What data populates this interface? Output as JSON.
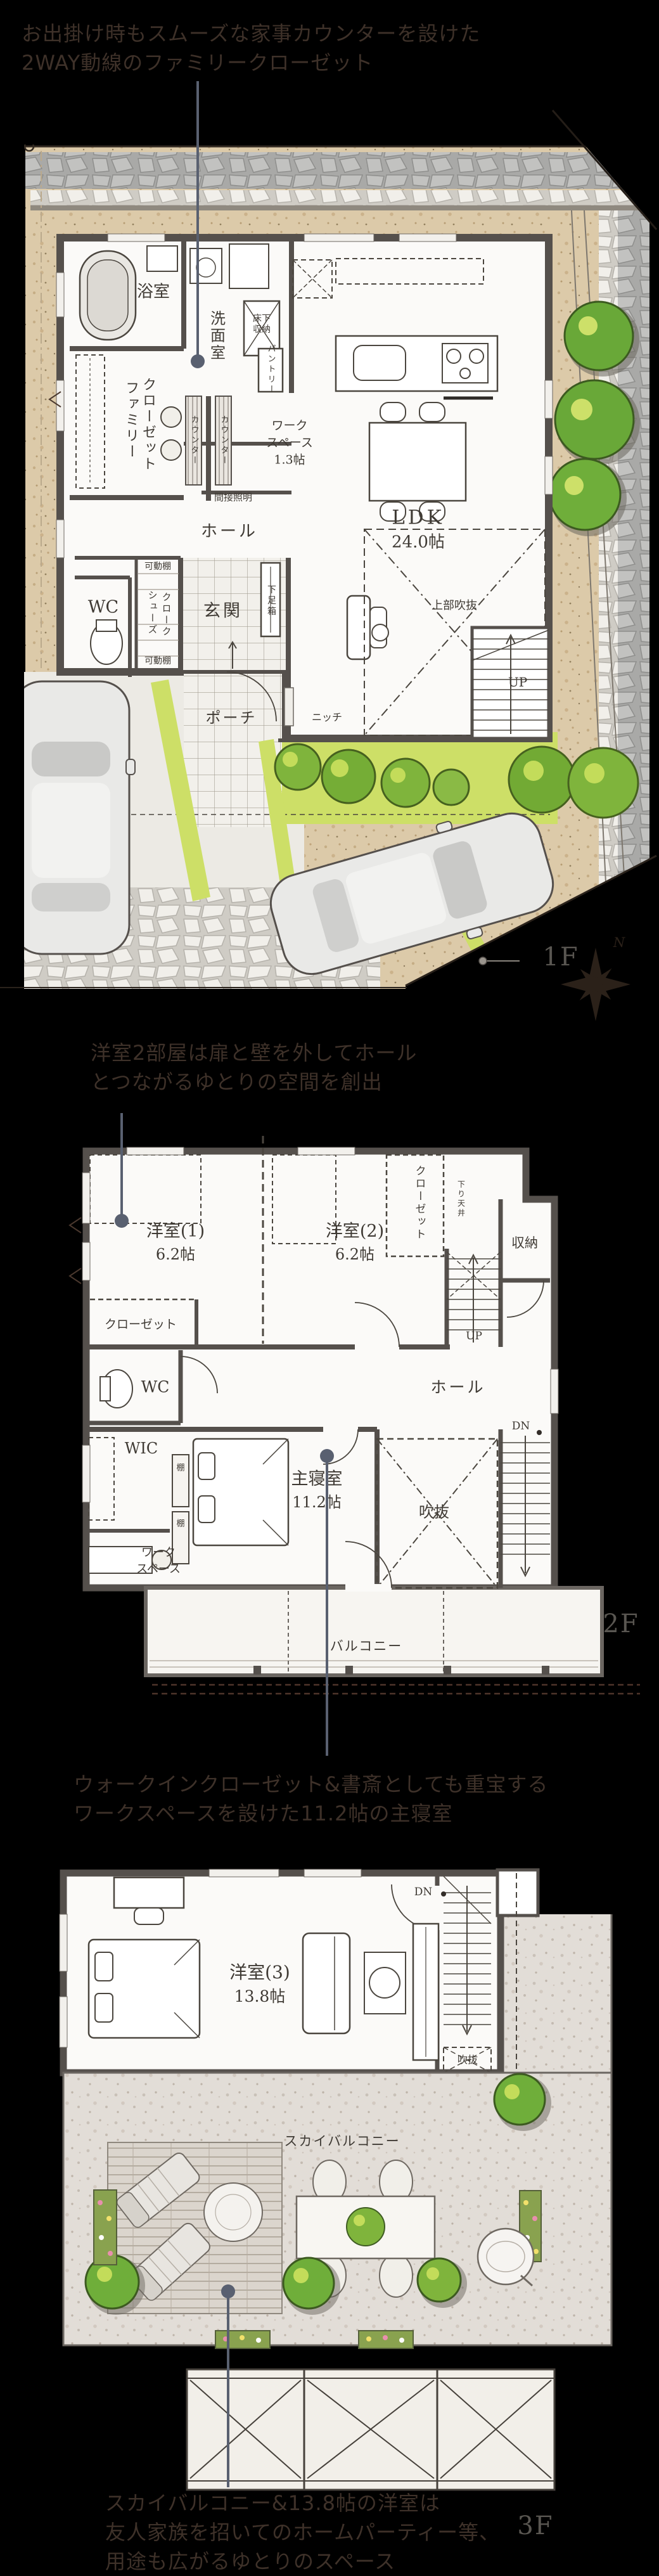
{
  "annotations": {
    "a1": {
      "lines": [
        "お出掛け時もスムーズな家事カウンターを設けた",
        "2WAY動線のファミリークローゼット"
      ]
    },
    "a2": {
      "lines": [
        "洋室2部屋は扉と壁を外してホール",
        "とつながるゆとりの空間を創出"
      ]
    },
    "a3": {
      "lines": [
        "ウォークインクローゼット&書斎としても重宝する",
        "ワークスペースを設けた11.2帖の主寝室"
      ]
    },
    "a4": {
      "lines": [
        "スカイバルコニー&13.8帖の洋室は",
        "友人家族を招いてのホームパーティー等、",
        "用途も広がるゆとりのスペース"
      ]
    }
  },
  "floor1": {
    "label": "1F",
    "compass_north": "N",
    "rooms": {
      "bath": "浴室",
      "washroom": "洗面室",
      "underfloor_1": "床下",
      "underfloor_2": "収納",
      "pantry": "パントリー",
      "counter": "カウンター",
      "family_1": "ファミリー",
      "family_2": "クローゼット",
      "indirect_light": "間接照明",
      "hall": "ホール",
      "movable_shelf": "可動棚",
      "wc": "WC",
      "shoes_1": "シューズ",
      "shoes_2": "クローク",
      "entrance": "玄関",
      "shoe_box": "下足箱",
      "porch": "ポーチ",
      "niche": "ニッチ",
      "ldk_1": "LDK",
      "ldk_2": "24.0帖",
      "void_above": "上部吹抜",
      "up": "UP",
      "workspace_1": "ワーク",
      "workspace_2": "スペース",
      "workspace_3": "1.3帖"
    }
  },
  "floor2": {
    "label": "2F",
    "rooms": {
      "y1": "洋室(1)",
      "y2": "洋室(2)",
      "size62": "6.2帖",
      "closet": "クローゼット",
      "lowered_ceiling": "下り天井",
      "storage": "収納",
      "up": "UP",
      "hall": "ホール",
      "wc": "WC",
      "wic": "WIC",
      "shelf": "棚",
      "master_1": "主寝室",
      "master_2": "11.2帖",
      "void": "吹抜",
      "dn": "DN",
      "workspace_1": "ワーク",
      "workspace_2": "スペース",
      "balcony": "バルコニー"
    }
  },
  "floor3": {
    "label": "3F",
    "rooms": {
      "y3_1": "洋室(3)",
      "y3_2": "13.8帖",
      "dn": "DN",
      "void": "吹抜",
      "sky_balcony": "スカイバルコニー"
    }
  },
  "colors": {
    "background": "#000000",
    "annotation_text": "#3e3129",
    "leader": "#596070",
    "wall": "#55504c",
    "paper": "#fbfaf8",
    "ground_beige": "#dccaa9",
    "lawn": "#cddf67",
    "bush_green": "#7fb43c",
    "floor_label_gray": "#595651"
  }
}
